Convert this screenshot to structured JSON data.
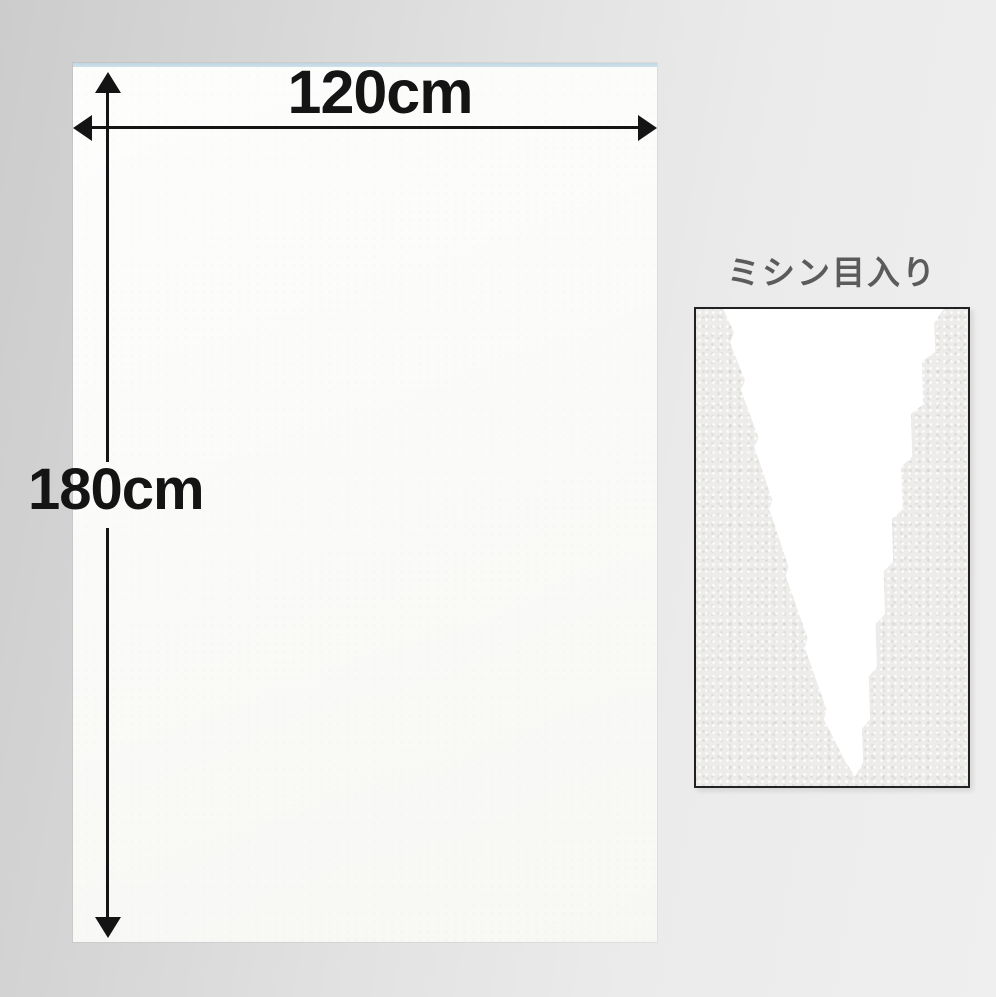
{
  "sheet": {
    "width_label": "120cm",
    "height_label": "180cm"
  },
  "inset": {
    "label": "ミシン目入り"
  },
  "icons": {
    "width_arrow": "double-headed-horizontal-dimension-arrow",
    "height_arrow": "double-headed-vertical-dimension-arrow"
  },
  "colors": {
    "background_left": "#cccccc",
    "background_right": "#efefef",
    "sheet": "#fbfbf9",
    "sheet_top_edge": "#cfe1ea",
    "annotation": "#141414",
    "inset_label": "#5b5b5b",
    "inset_border": "#222222",
    "inset_fabric": "#edecea",
    "tear": "#ffffff"
  }
}
